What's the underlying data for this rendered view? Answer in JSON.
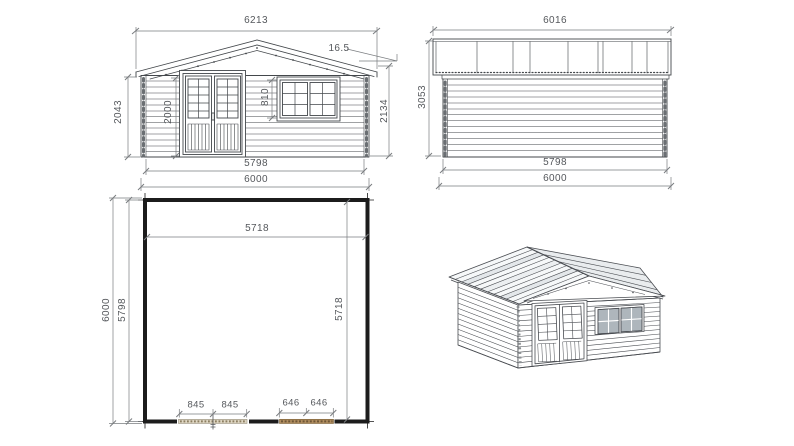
{
  "drawing": {
    "type": "log-cabin technical drawing, four views",
    "units": "mm",
    "colors": {
      "linework": "#43474b",
      "dimension": "#7a7d80",
      "dimension_text": "#55585c",
      "plan_wall": "#1c1c1c",
      "door_opening_hatch": "#ddd5c2",
      "window_opening_hatch": "#b08d5f",
      "roof_plank_shade": "#e3e7ea"
    }
  },
  "views": {
    "front_elevation": {
      "label": "front elevation",
      "dims": {
        "overall_width": "6213",
        "roof_pitch": "16.5",
        "left_height": "2043",
        "door_height": "2000",
        "window_height": "810",
        "right_height": "2134",
        "wall_width": "5798",
        "base_width": "6000"
      }
    },
    "side_elevation": {
      "label": "side elevation",
      "dims": {
        "roof_length": "6016",
        "total_height": "3053",
        "wall_length": "5798",
        "base_length": "6000"
      }
    },
    "floor_plan": {
      "label": "floor plan",
      "dims": {
        "outer_depth": "6000",
        "inner_depth": "5798",
        "inner_width_top": "5718",
        "inner_width_right": "5718",
        "door_seg_left": "845",
        "door_seg_right": "845",
        "window_seg_left": "646",
        "window_seg_right": "646"
      }
    },
    "iso_view": {
      "label": "3D perspective view"
    }
  }
}
